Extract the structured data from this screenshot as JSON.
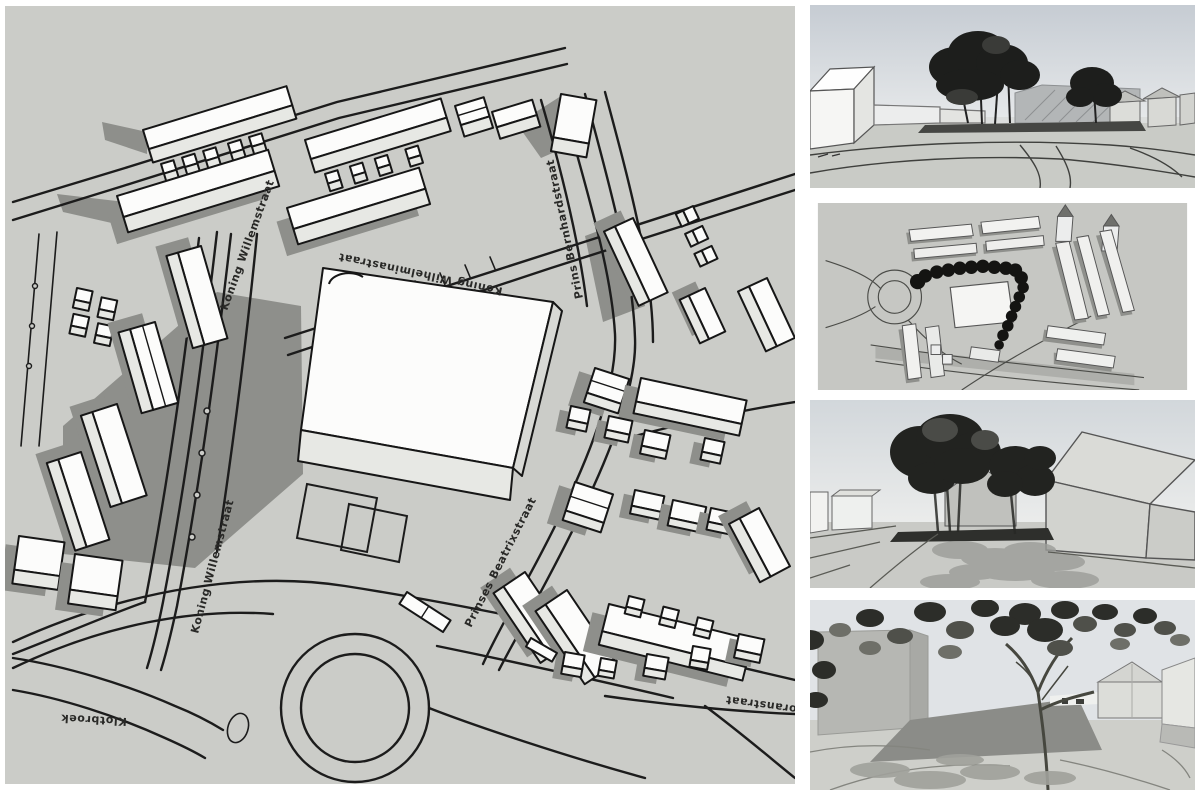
{
  "colors": {
    "canvas": "#cbccc8",
    "shadow": "#8e8f8b",
    "building_white": "#fcfcfb",
    "ink": "#1c1c1c",
    "sky": "#ccd2d8",
    "foliage": "#1d1e1c"
  },
  "main_plan": {
    "name": "axonometric-site-plan",
    "street_labels": {
      "koning_willemstraat": "Koning Willemstraat",
      "koning_wilhelminastraat": "Koning Wilhelminastraat",
      "prins_bernhardstraat": "Prins Bernhardstraat",
      "prinses_beatrixstraat": "Prinses Beatrixstraat",
      "klotbroek": "Klotbroek",
      "oranstraat": "oranstraat"
    }
  },
  "side_panels": [
    {
      "name": "perspective-render-street-north"
    },
    {
      "name": "aerial-massing-render"
    },
    {
      "name": "perspective-render-square"
    },
    {
      "name": "perspective-render-canopy"
    }
  ]
}
